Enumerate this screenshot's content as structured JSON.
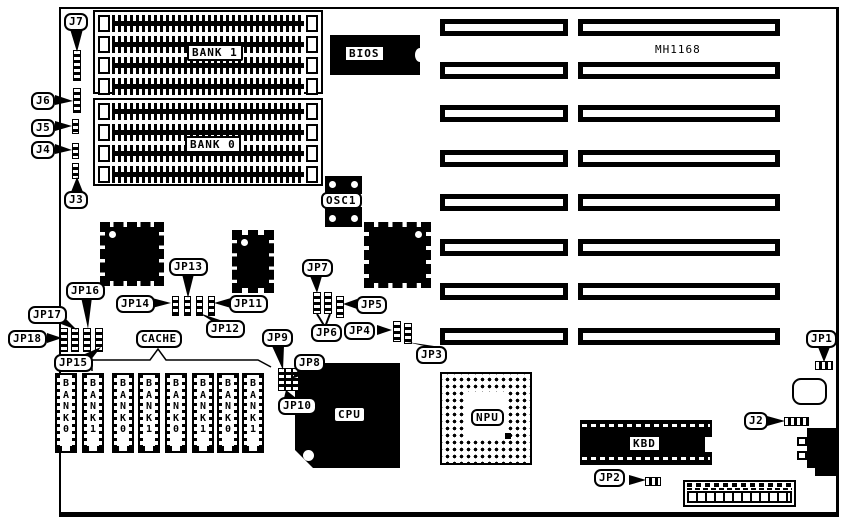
{
  "board": {
    "model": "MH1168"
  },
  "memory": {
    "bank1": "BANK 1",
    "bank0": "BANK 0"
  },
  "cache": {
    "label": "CACHE",
    "chips": [
      {
        "text": "BANK0"
      },
      {
        "text": "BANK1"
      },
      {
        "text": "BANK0"
      },
      {
        "text": "BANK1"
      },
      {
        "text": "BANK0"
      },
      {
        "text": "BANK1"
      },
      {
        "text": "BANK0"
      },
      {
        "text": "BANK1"
      }
    ]
  },
  "chips": {
    "bios": "BIOS",
    "osc1": "OSC1",
    "cpu": "CPU",
    "npu": "NPU",
    "kbd": "KBD"
  },
  "jumpers": {
    "j7": "J7",
    "j6": "J6",
    "j5": "J5",
    "j4": "J4",
    "j3": "J3",
    "j2": "J2",
    "jp18": "JP18",
    "jp17": "JP17",
    "jp16": "JP16",
    "jp15": "JP15",
    "jp14": "JP14",
    "jp13": "JP13",
    "jp12": "JP12",
    "jp11": "JP11",
    "jp10": "JP10",
    "jp9": "JP9",
    "jp8": "JP8",
    "jp7": "JP7",
    "jp6": "JP6",
    "jp5": "JP5",
    "jp4": "JP4",
    "jp3": "JP3",
    "jp2": "JP2",
    "jp1": "JP1"
  },
  "colors": {
    "line": "#000000",
    "background": "#ffffff"
  }
}
